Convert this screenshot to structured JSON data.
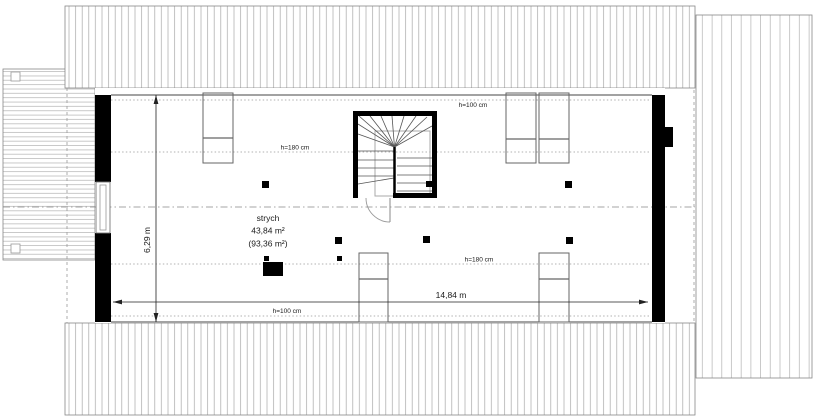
{
  "plan": {
    "room": {
      "name": "strych",
      "area_usable": "43,84 m²",
      "area_total": "(93,36 m²)"
    },
    "dimensions": {
      "width": "14,84 m",
      "depth": "6,29 m"
    },
    "height_labels": {
      "top_h100": "h=100 cm",
      "top_h180": "h=180 cm",
      "bottom_h180": "h=180 cm",
      "bottom_h100": "h=100 cm"
    },
    "colors": {
      "wall": "#000000",
      "roof_hatch": "#a8a8a8",
      "deck_stripe": "#b3b3b3",
      "height_line": "#999999",
      "ridge_line": "#888888",
      "dimension_line": "#222222",
      "text": "#1a1a1a"
    }
  }
}
